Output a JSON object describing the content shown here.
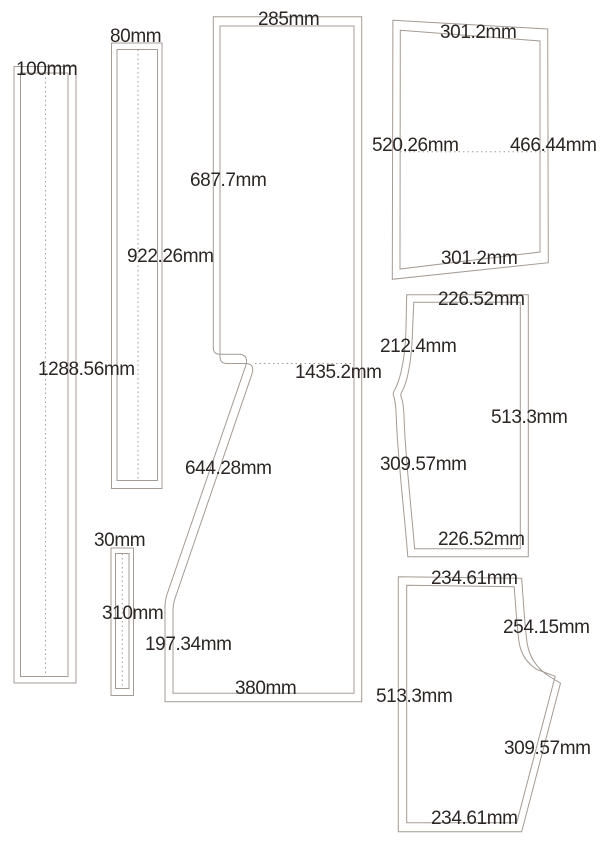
{
  "drawing_type": "sewing-pattern-layout",
  "units": "mm",
  "colors": {
    "outline": "#a49b94",
    "text": "#2b2623",
    "background": "#ffffff"
  },
  "pieces": {
    "strip_100": {
      "description": "tall narrow strip with double outline and dotted center fold line",
      "width_label": "100mm",
      "length_label": "1288.56mm"
    },
    "strip_80": {
      "description": "tall narrow strip with double outline and dotted center fold line",
      "width_label": "80mm",
      "length_label": "922.26mm"
    },
    "strip_30": {
      "description": "short narrow strip with double outline and dotted center fold line",
      "width_label": "30mm",
      "length_label": "310mm"
    },
    "main_panel": {
      "description": "large panel, straight top block with notched left step and flared lower section",
      "top_width_label": "285mm",
      "upper_length_label": "687.7mm",
      "overall_length_label": "1435.2mm",
      "slant_length_label": "644.28mm",
      "lower_side_label": "197.34mm",
      "bottom_width_label": "380mm"
    },
    "side_panel": {
      "description": "tilted trapezoid panel with dotted mid line",
      "top_width_label": "301.2mm",
      "left_length_label": "520.26mm",
      "right_length_label": "466.44mm",
      "bottom_width_label": "301.2mm"
    },
    "leg_panel_left_curve": {
      "description": "panel with crotch-curve notch on left edge",
      "top_width_label": "226.52mm",
      "upper_left_label": "212.4mm",
      "right_length_label": "513.3mm",
      "lower_left_label": "309.57mm",
      "bottom_width_label": "226.52mm"
    },
    "leg_panel_right_curve": {
      "description": "panel with crotch curve and slanted seam on right edge",
      "top_width_label": "234.61mm",
      "upper_right_label": "254.15mm",
      "left_length_label": "513.3mm",
      "lower_right_label": "309.57mm",
      "bottom_width_label": "234.61mm"
    }
  }
}
